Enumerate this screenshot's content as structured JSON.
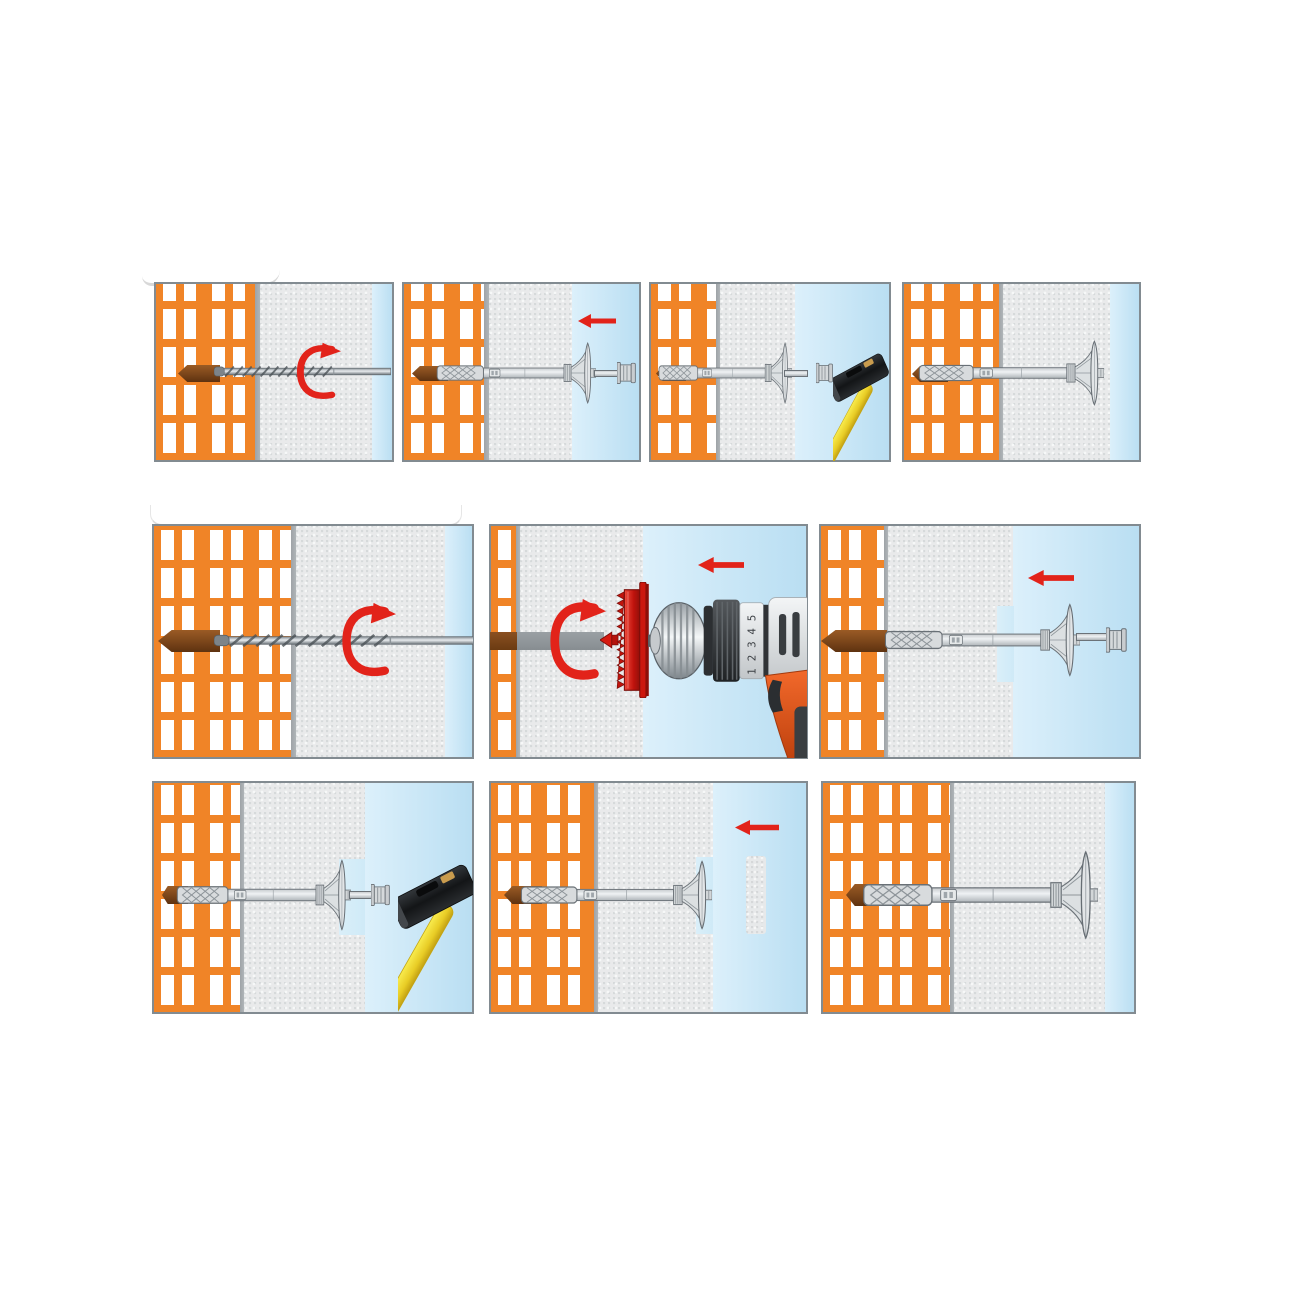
{
  "drill_clutch_numbers": [
    "1",
    "2",
    "3",
    "4",
    "5"
  ],
  "colors": {
    "accent_red": "#E2231A",
    "brick_orange": "#F08427",
    "mortar_gray": "#A4A9AD",
    "insulation_gray": "#E9EAEB",
    "plaster_blue_light": "#DCF0FB",
    "plaster_blue_dark": "#B9DEF2",
    "anchor_gray": "#D8DBDD",
    "anchor_outline": "#697076",
    "hole_brown": "#7A451A",
    "hammer_yellow": "#EFD93B",
    "hammer_black": "#1B1D1F",
    "drill_body_orange": "#E4571B",
    "cutter_red": "#C8170E",
    "panel_border": "#828B91"
  },
  "icons": {
    "rotation-arrow-icon": "↻",
    "arrow-left-icon": "←"
  }
}
